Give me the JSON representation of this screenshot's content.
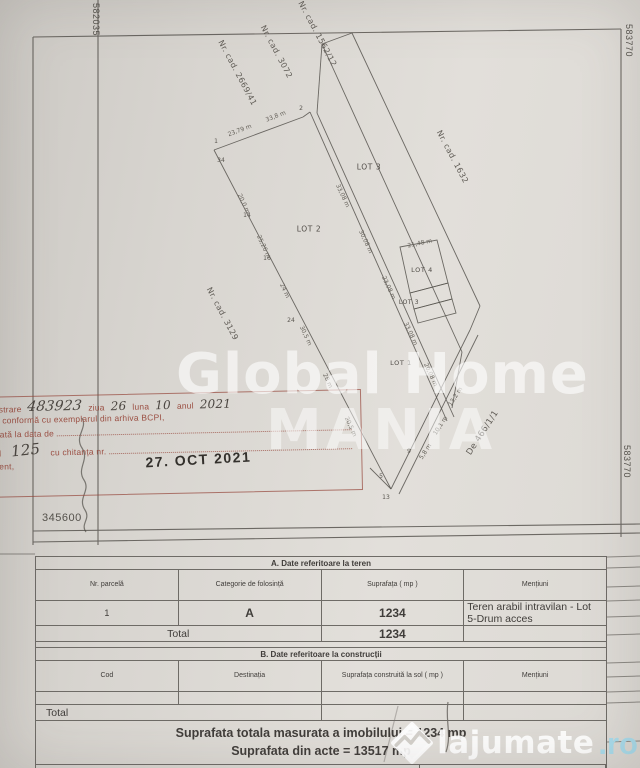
{
  "grid": {
    "top_left": "582035",
    "top_right": "583770",
    "bottom_right": "583770",
    "bottom_left": "345600"
  },
  "stamp": {
    "line1_label": "Înregistrare",
    "reg_no": "483923",
    "ziua_label": "ziua",
    "ziua": "26",
    "luna_label": "luna",
    "luna": "10",
    "anul_label": "anul",
    "anul": "2021",
    "line2": "Copie conformă cu exemplarul din arhiva BCPI,",
    "line3": "Eliberată la data de",
    "line4_prefix": "Tariful",
    "fee": "125",
    "line4_suffix": "cu chitanța nr.",
    "line5": "Referent,",
    "date": "27. OCT 2021"
  },
  "watermarks": {
    "global_home": "Global Home",
    "mania": "MANIA",
    "lajumate": "lajumate",
    "lajumate_tld": ".ro"
  },
  "drawing": {
    "lines": [
      [
        214,
        150,
        303,
        117
      ],
      [
        303,
        117,
        310,
        112
      ],
      [
        214,
        150,
        391,
        489
      ],
      [
        310,
        112,
        447,
        421
      ],
      [
        317,
        113,
        454,
        417
      ],
      [
        317,
        113,
        322,
        44
      ],
      [
        322,
        44,
        462,
        352
      ],
      [
        322,
        44,
        352,
        33
      ],
      [
        352,
        33,
        480,
        306
      ],
      [
        462,
        352,
        452,
        408
      ],
      [
        480,
        306,
        470,
        330
      ],
      [
        391,
        489,
        470,
        330
      ],
      [
        399,
        494,
        478,
        335
      ],
      [
        370,
        468,
        391,
        489
      ]
    ],
    "polys": [
      [
        400,
        247,
        437,
        240,
        448,
        283,
        410,
        293
      ],
      [
        410,
        293,
        448,
        283,
        452,
        299,
        414,
        309
      ],
      [
        414,
        309,
        452,
        299,
        456,
        313,
        418,
        323
      ]
    ],
    "labels": [
      {
        "t": "Nr. cad. 2669/41",
        "x": 237,
        "y": 73,
        "r": 62,
        "s": 8,
        "c": "nrcad"
      },
      {
        "t": "Nr. cad. 3072",
        "x": 276,
        "y": 52,
        "r": 62,
        "s": 8,
        "c": "nrcad"
      },
      {
        "t": "Nr. cad. 1562/12",
        "x": 317,
        "y": 34,
        "r": 62,
        "s": 8,
        "c": "nrcad"
      },
      {
        "t": "Nr. cad. 1632",
        "x": 452,
        "y": 157,
        "r": 62,
        "s": 8,
        "c": "nrcad"
      },
      {
        "t": "Nr. cad. 3129",
        "x": 222,
        "y": 314,
        "r": 62,
        "s": 8,
        "c": "nrcad"
      },
      {
        "t": "De 466/1/1",
        "x": 483,
        "y": 433,
        "r": -57,
        "s": 8.5,
        "c": "nrcad"
      },
      {
        "t": "LOT 2",
        "x": 309,
        "y": 229,
        "r": 0,
        "s": 7.5,
        "c": "lot"
      },
      {
        "t": "LOT 3",
        "x": 369,
        "y": 167,
        "r": 0,
        "s": 7.5,
        "c": "lot"
      },
      {
        "t": "LOT 4",
        "x": 422,
        "y": 270,
        "r": 0,
        "s": 6.5,
        "c": "lot"
      },
      {
        "t": "LOT 3",
        "x": 409,
        "y": 303,
        "r": 0,
        "s": 6,
        "c": "lot"
      },
      {
        "t": "LOT 1",
        "x": 401,
        "y": 363,
        "r": 0,
        "s": 6.5,
        "c": "lot"
      },
      {
        "t": "23,79 m",
        "x": 240,
        "y": 131,
        "r": -21,
        "s": 6,
        "c": "dim"
      },
      {
        "t": "33,8 m",
        "x": 276,
        "y": 117,
        "r": -21,
        "s": 6,
        "c": "dim"
      },
      {
        "t": "21,48 m",
        "x": 420,
        "y": 244,
        "r": -12,
        "s": 6,
        "c": "dim"
      },
      {
        "t": "20,0 m",
        "x": 243,
        "y": 204,
        "r": 65,
        "s": 6,
        "c": "dim"
      },
      {
        "t": "25,26 m",
        "x": 263,
        "y": 247,
        "r": 65,
        "s": 6,
        "c": "dim"
      },
      {
        "t": "24 m",
        "x": 284,
        "y": 291,
        "r": 65,
        "s": 6,
        "c": "dim"
      },
      {
        "t": "30,5 m",
        "x": 305,
        "y": 336,
        "r": 65,
        "s": 6,
        "c": "dim"
      },
      {
        "t": "28 m",
        "x": 327,
        "y": 381,
        "r": 65,
        "s": 6,
        "c": "dim"
      },
      {
        "t": "20,5 m",
        "x": 350,
        "y": 427,
        "r": 65,
        "s": 6,
        "c": "dim"
      },
      {
        "t": "33,08 m",
        "x": 342,
        "y": 196,
        "r": 65,
        "s": 6,
        "c": "dim"
      },
      {
        "t": "30,08 m",
        "x": 365,
        "y": 242,
        "r": 65,
        "s": 6,
        "c": "dim"
      },
      {
        "t": "23,08 m",
        "x": 388,
        "y": 288,
        "r": 65,
        "s": 6,
        "c": "dim"
      },
      {
        "t": "33,08 m",
        "x": 410,
        "y": 334,
        "r": 65,
        "s": 6,
        "c": "dim"
      },
      {
        "t": "20,08 m",
        "x": 430,
        "y": 375,
        "r": 65,
        "s": 6,
        "c": "dim"
      },
      {
        "t": "13,2 m",
        "x": 456,
        "y": 397,
        "r": -57,
        "s": 6,
        "c": "dim"
      },
      {
        "t": "10,1 m",
        "x": 441,
        "y": 426,
        "r": -57,
        "s": 6,
        "c": "dim"
      },
      {
        "t": "5,8 m",
        "x": 426,
        "y": 452,
        "r": -57,
        "s": 6,
        "c": "dim"
      },
      {
        "t": "1",
        "x": 216,
        "y": 142,
        "r": 0,
        "s": 6,
        "c": "pt"
      },
      {
        "t": "2",
        "x": 301,
        "y": 109,
        "r": 0,
        "s": 6,
        "c": "pt"
      },
      {
        "t": "34",
        "x": 221,
        "y": 161,
        "r": 0,
        "s": 6,
        "c": "pt"
      },
      {
        "t": "14",
        "x": 247,
        "y": 216,
        "r": 0,
        "s": 6,
        "c": "pt"
      },
      {
        "t": "16",
        "x": 267,
        "y": 259,
        "r": 0,
        "s": 6,
        "c": "pt"
      },
      {
        "t": "24",
        "x": 291,
        "y": 321,
        "r": 0,
        "s": 6,
        "c": "pt"
      },
      {
        "t": "5",
        "x": 381,
        "y": 477,
        "r": 0,
        "s": 6,
        "c": "pt"
      },
      {
        "t": "13",
        "x": 386,
        "y": 498,
        "r": 0,
        "s": 6,
        "c": "pt"
      },
      {
        "t": "9",
        "x": 409,
        "y": 452,
        "r": 0,
        "s": 6,
        "c": "pt"
      }
    ]
  },
  "tables": {
    "a": {
      "title": "A. Date referitoare la teren",
      "headers": [
        "Nr. parcelă",
        "Categorie de folosință",
        "Suprafața ( mp )",
        "Mențiuni"
      ],
      "rows": [
        [
          "1",
          "A",
          "1234",
          "Teren arabil intravilan - Lot 5-Drum acces"
        ]
      ],
      "total_label": "Total",
      "total_value": "1234"
    },
    "b": {
      "title": "B. Date referitoare la construcții",
      "headers": [
        "Cod",
        "Destinația",
        "Suprafața construită la sol ( mp )",
        "Mențiuni"
      ],
      "total_label": "Total"
    },
    "summary_line1": "Suprafata totala masurata a imobilului = 1234 mp",
    "summary_line2": "Suprafata din acte = 13517 mp",
    "executant_label": "Executant:"
  }
}
